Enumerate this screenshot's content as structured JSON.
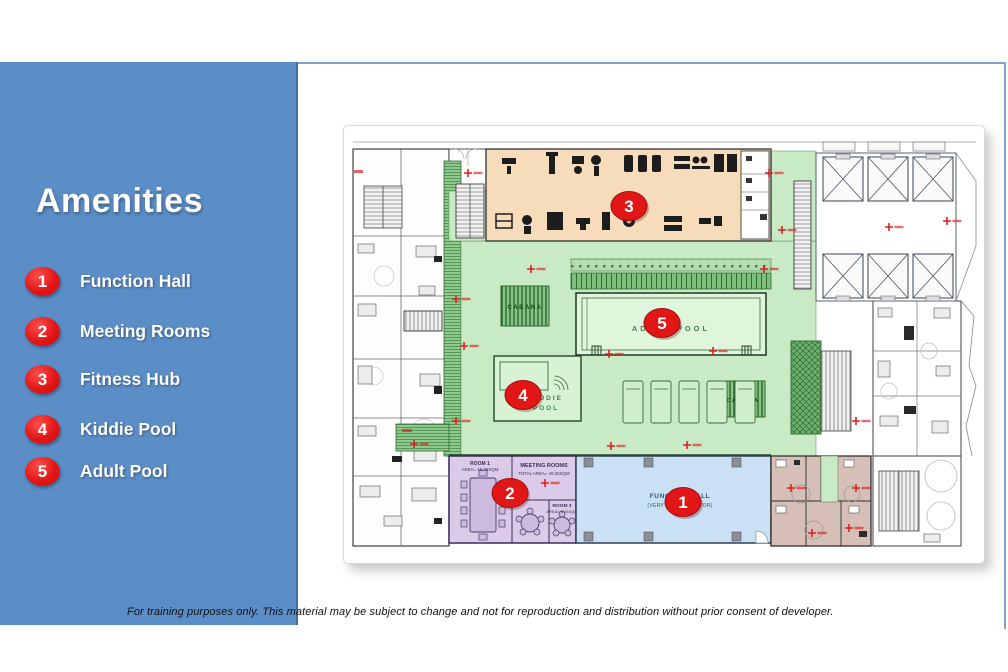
{
  "slide": {
    "title": "Amenities",
    "footer": "For training purposes only. This material may be subject to change and not for reproduction and distribution without prior consent of developer."
  },
  "colors": {
    "sidebar_blue": "#5b8dc7",
    "badge_red": "#e11616",
    "pool_deck_green": "#c8eac5",
    "fitness_tan": "#f6dcba",
    "meeting_purple": "#dccbe8",
    "function_blue": "#c9e0f5"
  },
  "legend": [
    {
      "num": "1",
      "label": "Function Hall"
    },
    {
      "num": "2",
      "label": "Meeting Rooms"
    },
    {
      "num": "3",
      "label": "Fitness Hub"
    },
    {
      "num": "4",
      "label": "Kiddie Pool"
    },
    {
      "num": "5",
      "label": "Adult Pool"
    }
  ],
  "plan": {
    "markers": {
      "m1": "1",
      "m2": "2",
      "m3": "3",
      "m4": "4",
      "m5": "5"
    },
    "labels": {
      "adult_pool": "ADULT POOL",
      "kiddie_pool_1": "KIDDIE",
      "kiddie_pool_2": "POOL",
      "cabana": "CABANA",
      "function_hall_1": "FUNCTION HALL",
      "function_hall_2": "(VERY NEAR ELEVATOR)",
      "meeting_rooms_1": "MEETING ROOMS",
      "meeting_rooms_2": "TOTAL AREA= 49.26SQM",
      "room1_1": "ROOM 1",
      "room1_2": "AREA= 15.26SQM",
      "room3_1": "ROOM 3",
      "room3_2": "AREA= 8.26SQM"
    }
  }
}
